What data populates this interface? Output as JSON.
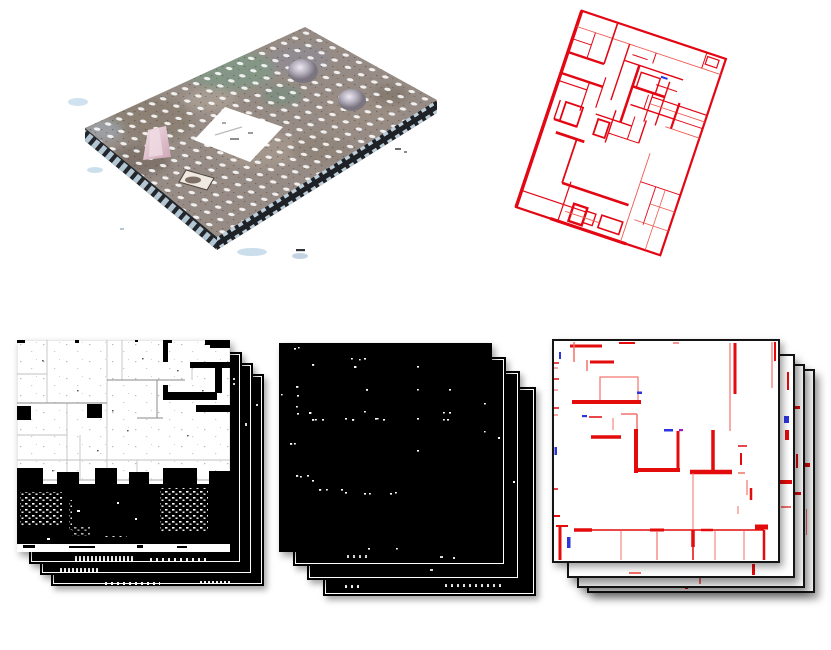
{
  "figure": {
    "title": "Point cloud to floor plan pipeline figure",
    "background_color": "#ffffff",
    "panels": [
      {
        "id": "point-cloud",
        "label": "3D textured point cloud of a building storey with ceiling lights and central atrium opening",
        "position": "top-left"
      },
      {
        "id": "floorplan",
        "label": "Rotated red-line architectural floor plan with small blue marker",
        "position": "top-right",
        "rotation_deg": 18.5
      },
      {
        "id": "density-stack",
        "label": "Stack of 4 binary density slice maps (white background, black occupancy)",
        "position": "bottom-left",
        "sheet_count": 4
      },
      {
        "id": "sparse-stack",
        "label": "Stack of 4 sparse point slice maps (black background, white points)",
        "position": "bottom-center",
        "sheet_count": 4
      },
      {
        "id": "wall-stack",
        "label": "Stack of 4 extracted wall-segment slices (white sheets, red walls, blue markers)",
        "position": "bottom-right",
        "sheet_count": 4
      }
    ],
    "colors": {
      "wall_red": "#e30b0b",
      "wall_red_light": "#f2716a",
      "marker_blue": "#2d35dd",
      "marker_purple": "#a018c0",
      "plan_red": "#e30613",
      "slice_black": "#000000",
      "slice_white": "#ffffff",
      "cloud_base": "#978c85",
      "cloud_green_glass": "#7e9a87",
      "cloud_dome": "#b4aebc",
      "cloud_edge_tile": "#cfe3ef"
    }
  }
}
